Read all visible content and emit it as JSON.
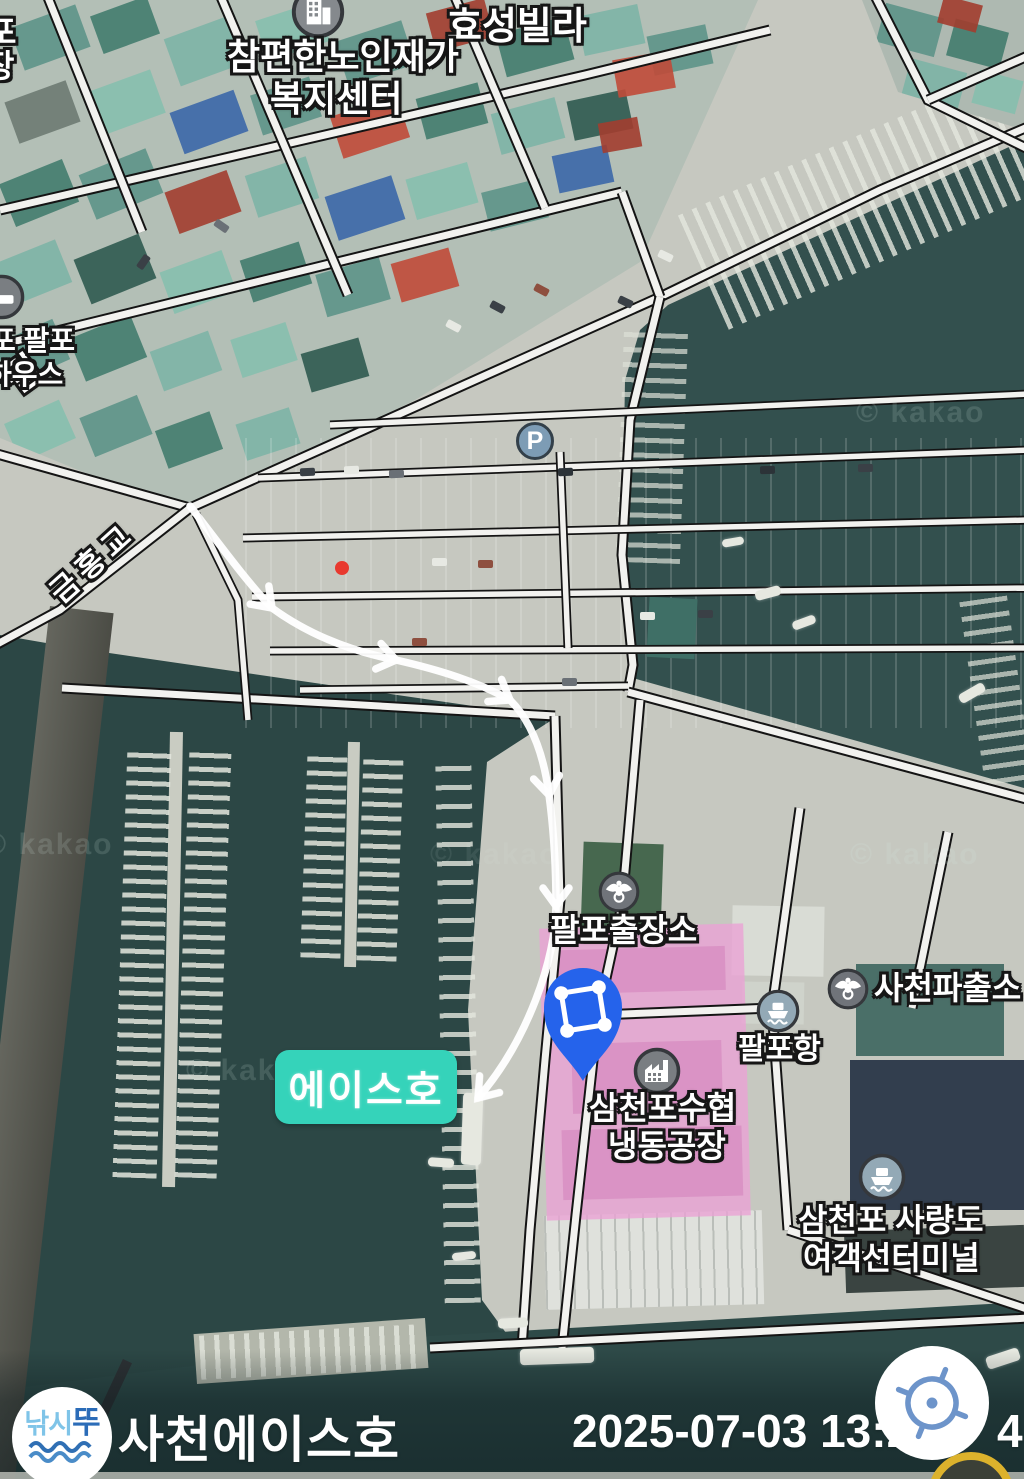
{
  "map": {
    "watermark": "© kakao",
    "poi": {
      "hyoseong_villa": "효성빌라",
      "senior_welfare_center_line1": "참편한노인재가",
      "senior_welfare_center_line2": "복지센터",
      "geumhong_bridge": "금홍교",
      "parking_symbol": "P",
      "palpo_branch_office": "팔포출장소",
      "sacheon_police_box": "사천파출소",
      "palpo_port": "팔포항",
      "samcheonpo_fisheries_line1": "삼천포수협",
      "samcheonpo_fisheries_line2": "냉동공장",
      "ferry_terminal_line1": "삼천포 사량도",
      "ferry_terminal_line2": "여객선터미널",
      "ace_boat_tag": "에이스호",
      "partial_label_char1": "포",
      "partial_label_char2": "장",
      "partial_road_suffix": "길",
      "partial_guesthouse_line1": "포 팔포",
      "partial_guesthouse_line2": "하우스"
    },
    "colors": {
      "pin_blue": "#2563eb",
      "ace_tag_bg": "#35d3ba",
      "highlight_pink": "#eba4d4"
    }
  },
  "footer": {
    "logo_text_part1": "낚시",
    "logo_text_part2": "뚜",
    "boat_title": "사천에이스호",
    "timestamp_visible_left": "2025-07-03 13:2",
    "timestamp_visible_right": "4"
  }
}
